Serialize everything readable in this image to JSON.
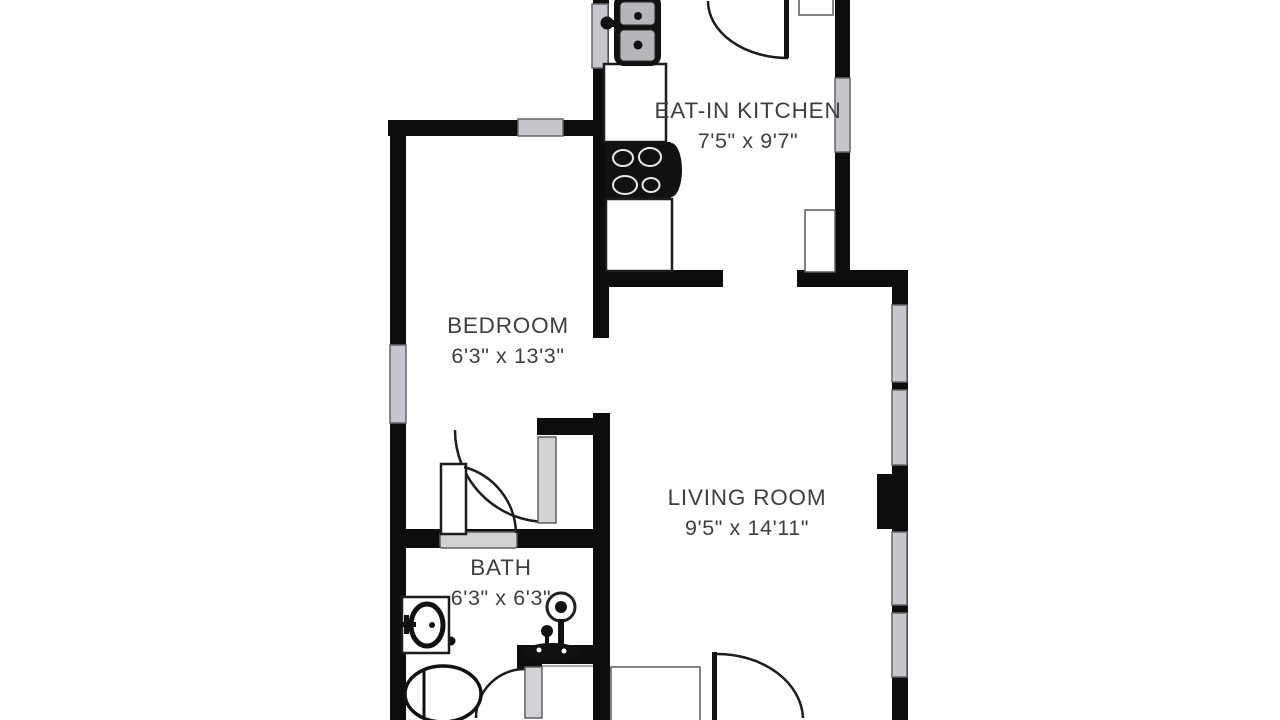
{
  "image": {
    "type": "floor-plan",
    "background": "#ffffff"
  },
  "colors": {
    "wall": "#0d0d0d",
    "window_fill": "#c6c7cc",
    "window_border": "#64666d",
    "door_arc": "#1d1d1d",
    "label_text": "#3d3f42"
  },
  "floor_plan": {
    "rooms": [
      {
        "id": "eat_in_kitchen",
        "name": "EAT-IN KITCHEN",
        "dimensions": "7'5\" x 9'7\""
      },
      {
        "id": "bedroom",
        "name": "BEDROOM",
        "dimensions": "6'3\" x 13'3\""
      },
      {
        "id": "living_room",
        "name": "LIVING ROOM",
        "dimensions": "9'5\" x 14'11\""
      },
      {
        "id": "bath",
        "name": "BATH",
        "dimensions": "6'3\" x 6'3\""
      }
    ],
    "fixtures": [
      "kitchen-sink",
      "stove",
      "refrigerator",
      "kitchen-counters",
      "wall-cabinet",
      "bath-sink",
      "shower",
      "toilet",
      "closet-door",
      "swing-doors",
      "windows",
      "chimney"
    ]
  }
}
